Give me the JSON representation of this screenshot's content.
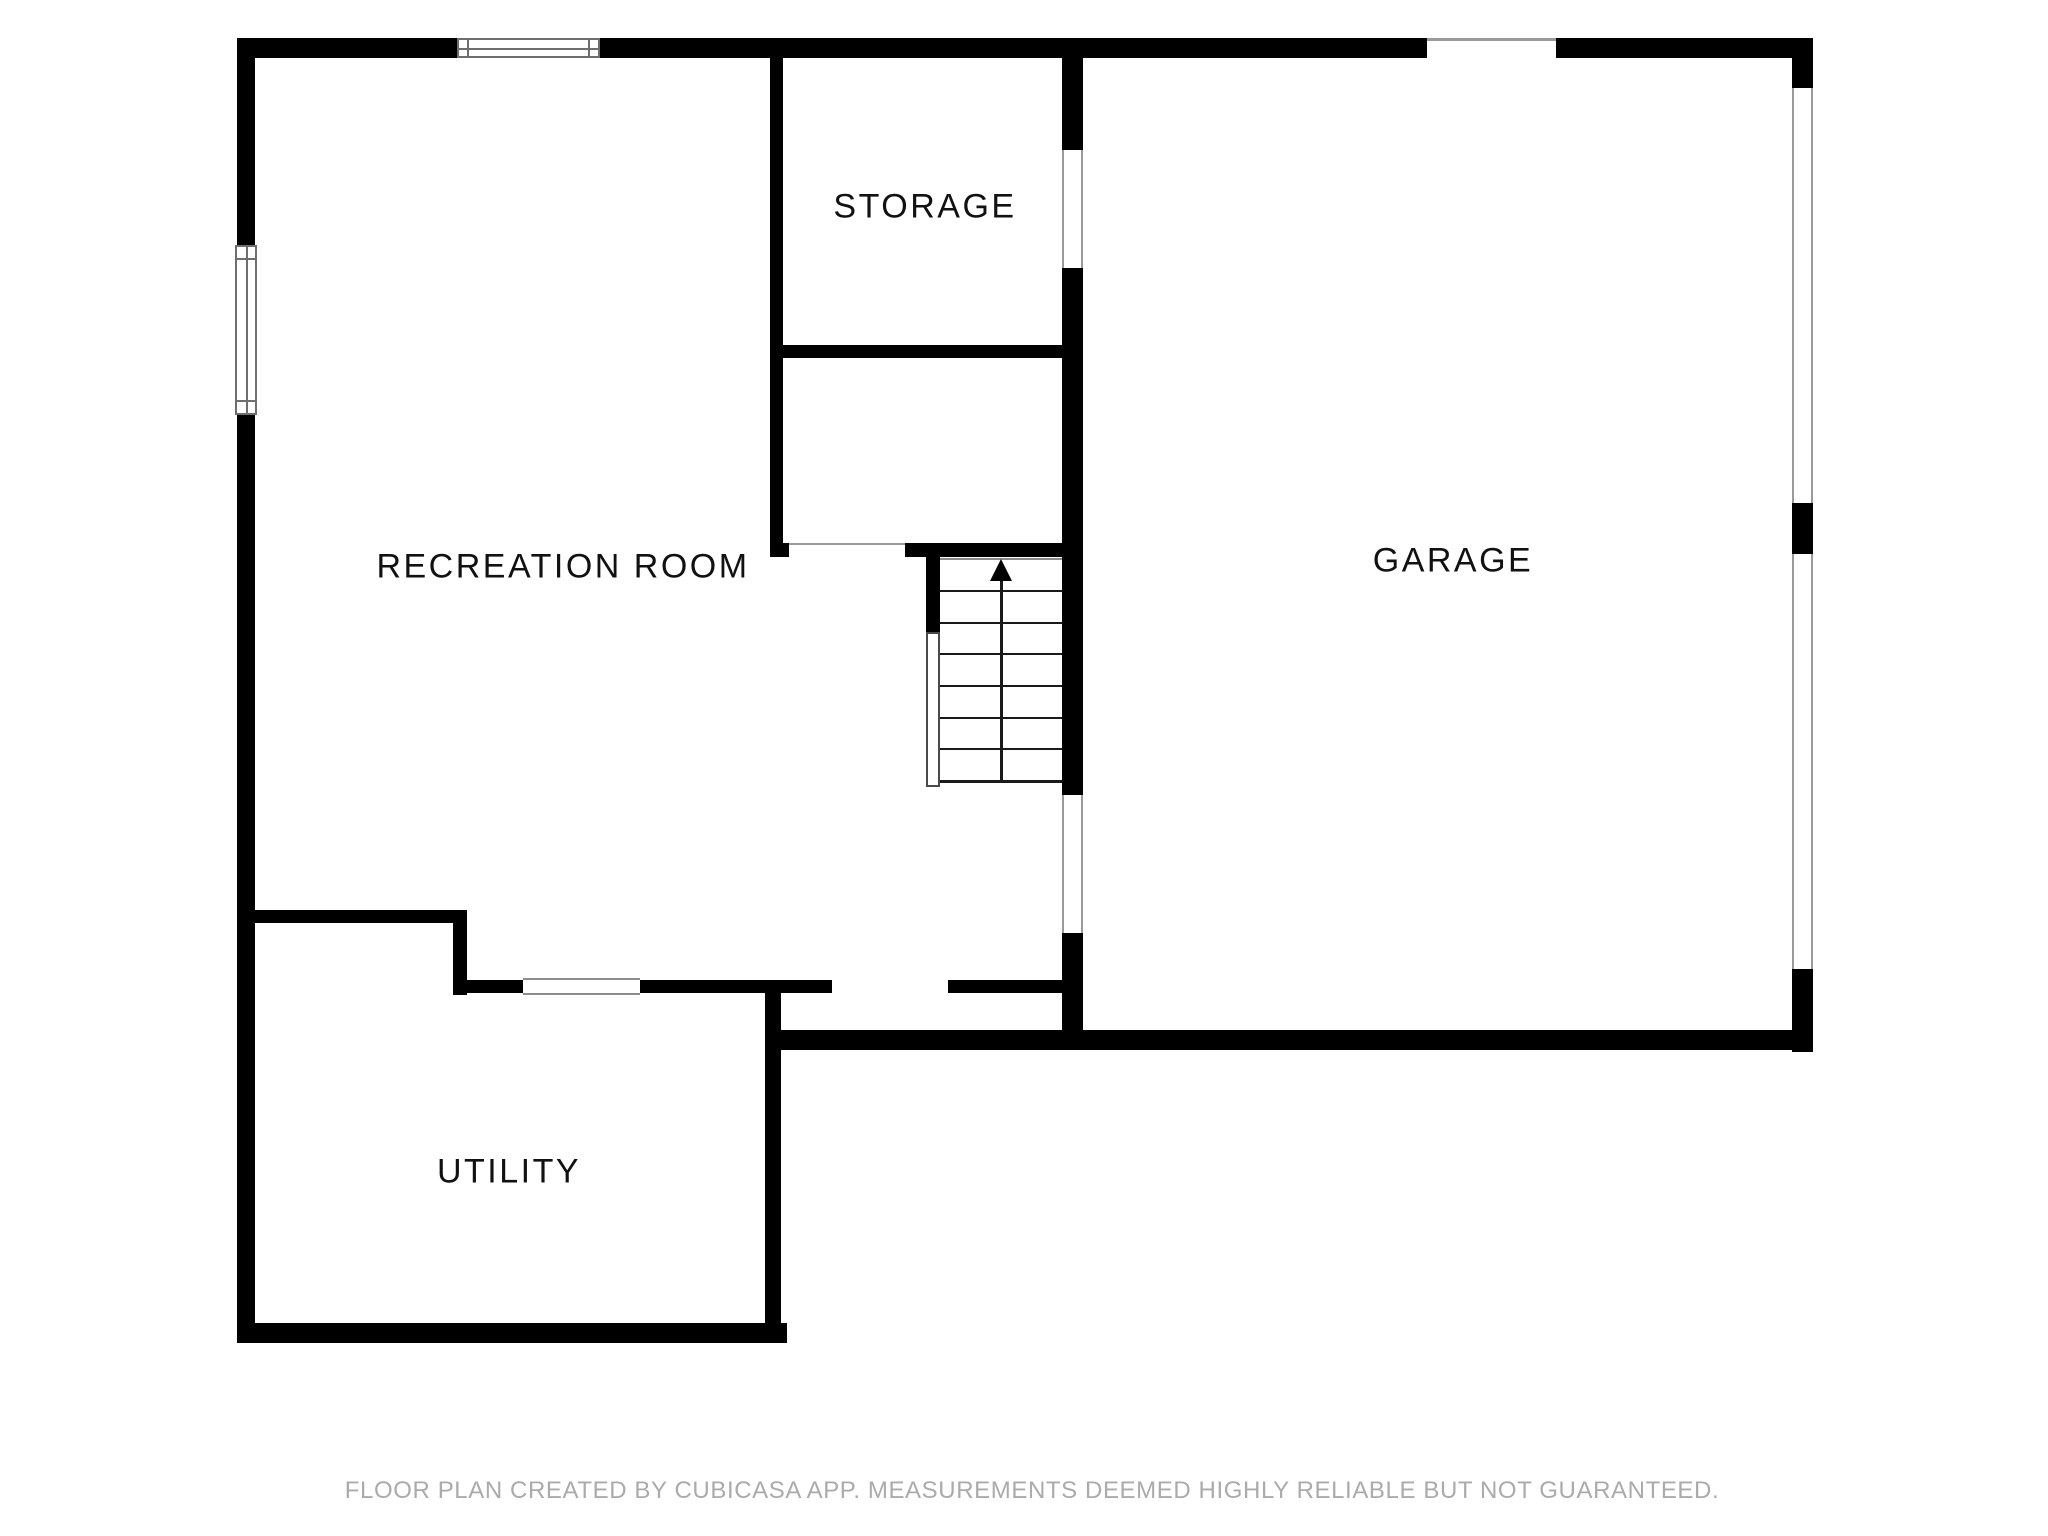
{
  "floor_plan": {
    "rooms": [
      {
        "id": "recreation-room",
        "label": "RECREATION ROOM"
      },
      {
        "id": "storage",
        "label": "STORAGE"
      },
      {
        "id": "garage",
        "label": "GARAGE"
      },
      {
        "id": "utility",
        "label": "UTILITY"
      }
    ],
    "stairs": {
      "icon": "up-arrow",
      "direction": "up"
    },
    "colors": {
      "wall": "#000000",
      "window_frame": "#6e6e6e",
      "opening_line": "#9a9a9a",
      "label_text": "#111111",
      "footer_text": "#ababab",
      "background": "#ffffff"
    }
  },
  "footer": {
    "disclaimer": "FLOOR PLAN CREATED BY CUBICASA APP. MEASUREMENTS DEEMED HIGHLY RELIABLE BUT NOT GUARANTEED."
  }
}
